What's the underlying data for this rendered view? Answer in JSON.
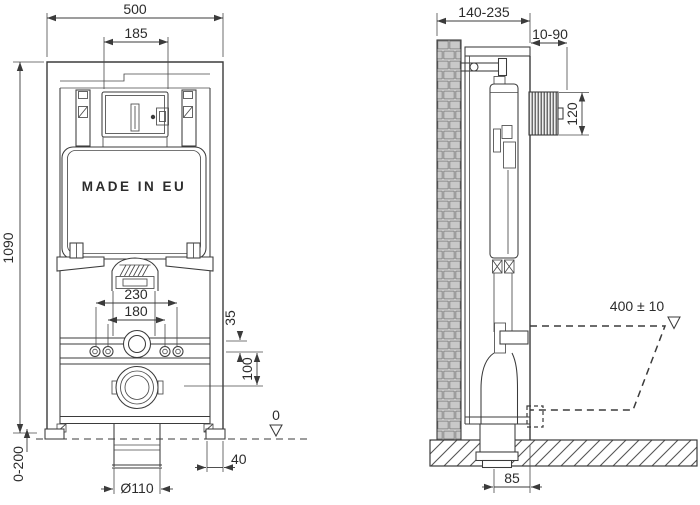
{
  "colors": {
    "line": "#3b3b3b",
    "brick_fill": "#c9c9c9",
    "hatch": "#555555"
  },
  "front_view": {
    "made_in_eu": "MADE IN EU",
    "dims": {
      "total_width": "500",
      "plate_opening_width": "185",
      "frame_height": "1090",
      "foot_adjust_range": "0-200",
      "fixing_span_outer": "230",
      "fixing_span_inner": "180",
      "offset_rail_to_bolts": "35",
      "offset_bolts_to_drain": "100",
      "floor_datum": "0",
      "foot_width": "40",
      "drain_diameter": "Ø110"
    }
  },
  "side_view": {
    "dims": {
      "frame_depth_range": "140-235",
      "wall_finish_range": "10-90",
      "flush_plate_height": "120",
      "bowl_rim_height": "400 ± 10",
      "drain_wall_offset": "85"
    }
  }
}
